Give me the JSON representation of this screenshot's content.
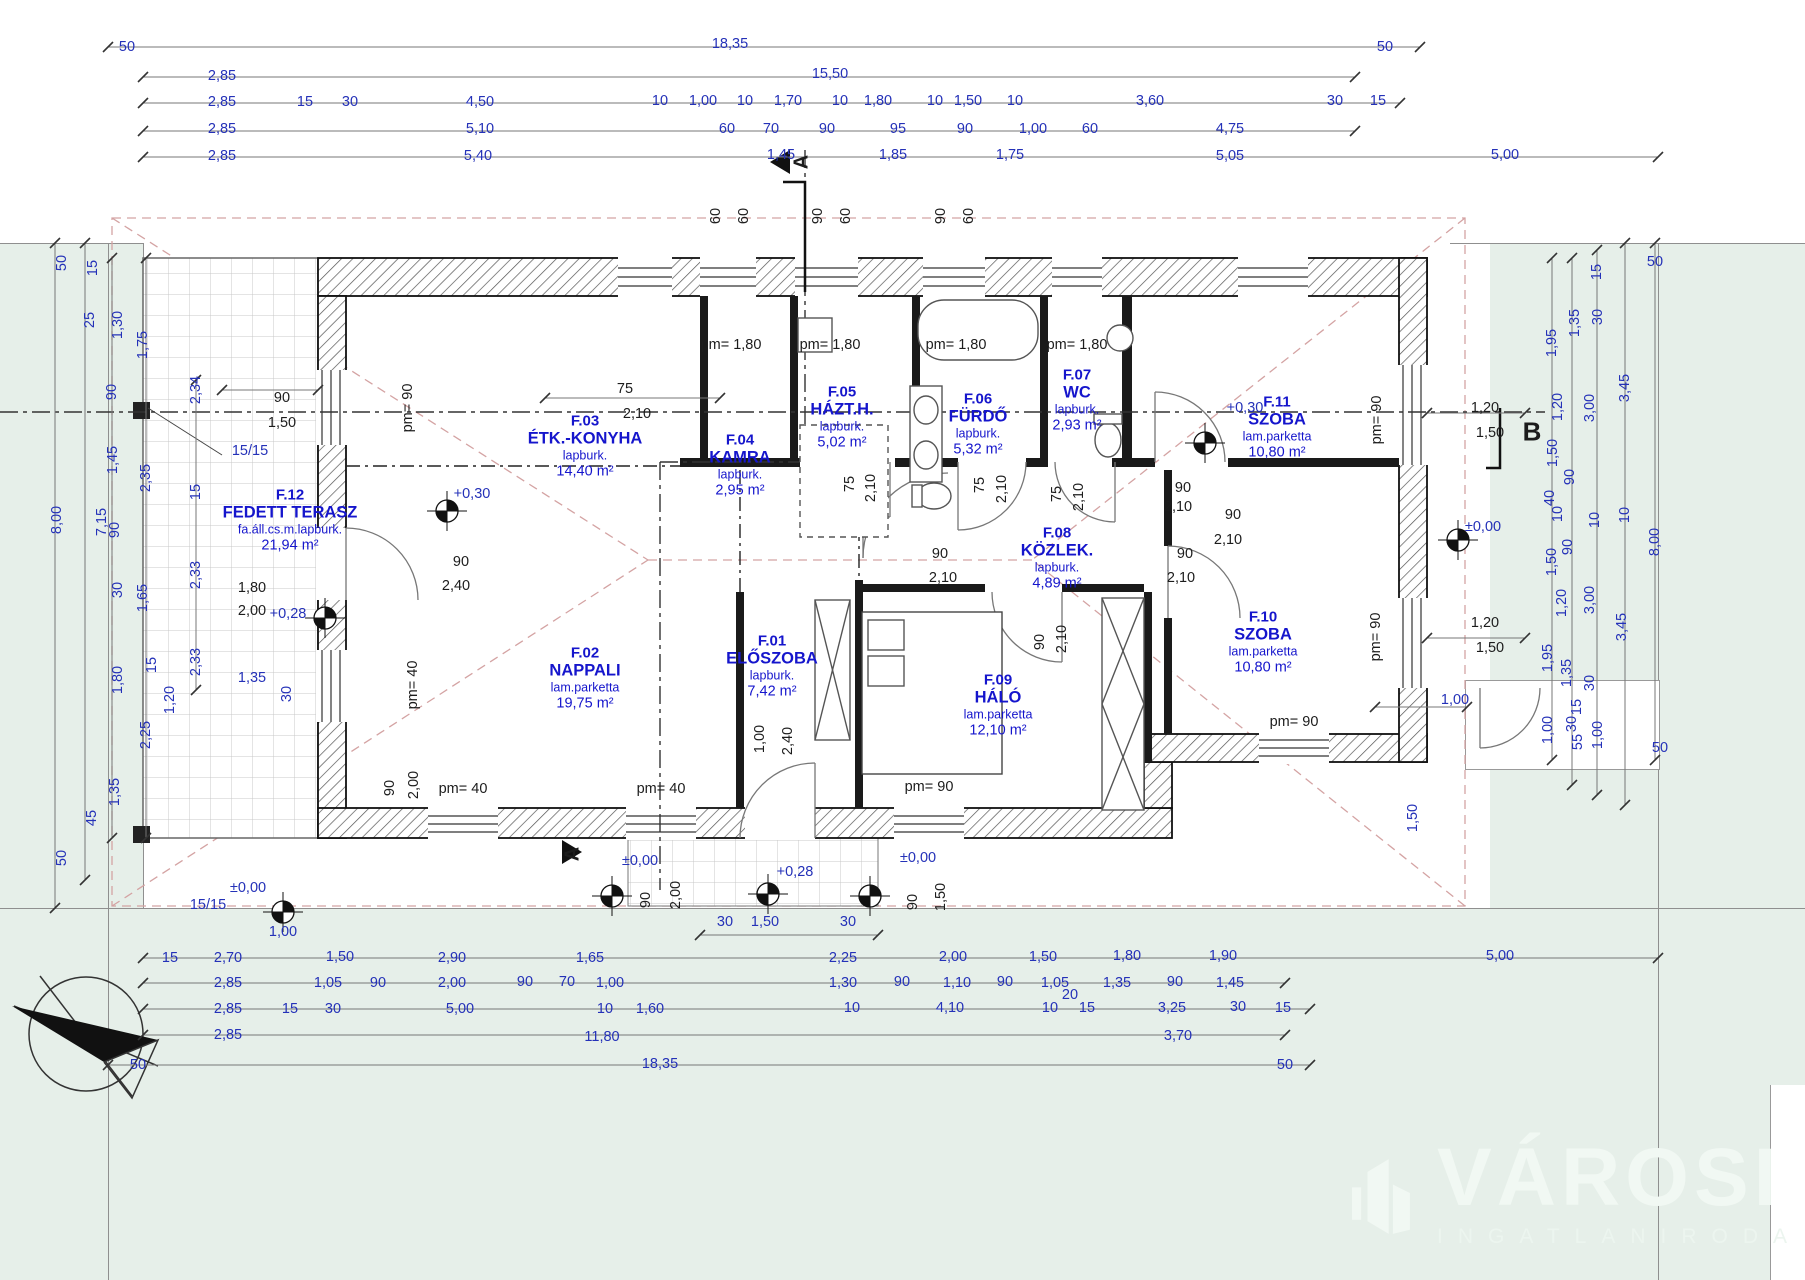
{
  "logo": {
    "title": "VÁROSI",
    "subtitle": "INGATLANIRODA",
    "color": "#f1f8f3"
  },
  "colors": {
    "terrain": "#e6efe9",
    "dim_blue": "#2431b8",
    "room_blue": "#1515cc",
    "roof_dash": "#d4a3a3"
  },
  "rooms": [
    {
      "id": "F.01",
      "name": "ELŐSZOBA",
      "finish": "lapburk.",
      "area": "7,42 m²",
      "cx": 772,
      "cy": 666
    },
    {
      "id": "F.02",
      "name": "NAPPALI",
      "finish": "lam.parketta",
      "area": "19,75 m²",
      "cx": 585,
      "cy": 678
    },
    {
      "id": "F.03",
      "name": "ÉTK.-KONYHA",
      "finish": "lapburk.",
      "area": "14,40 m²",
      "cx": 585,
      "cy": 446
    },
    {
      "id": "F.04",
      "name": "KAMRA",
      "finish": "lapburk.",
      "area": "2,95 m²",
      "cx": 740,
      "cy": 465
    },
    {
      "id": "F.05",
      "name": "HÁZT.H.",
      "finish": "lapburk.",
      "area": "5,02 m²",
      "cx": 842,
      "cy": 417
    },
    {
      "id": "F.06",
      "name": "FÜRDŐ",
      "finish": "lapburk.",
      "area": "5,32 m²",
      "cx": 978,
      "cy": 424
    },
    {
      "id": "F.07",
      "name": "WC",
      "finish": "lapburk.",
      "area": "2,93 m²",
      "cx": 1077,
      "cy": 400
    },
    {
      "id": "F.08",
      "name": "KÖZLEK.",
      "finish": "lapburk.",
      "area": "4,89 m²",
      "cx": 1057,
      "cy": 558
    },
    {
      "id": "F.09",
      "name": "HÁLÓ",
      "finish": "lam.parketta",
      "area": "12,10 m²",
      "cx": 998,
      "cy": 705
    },
    {
      "id": "F.10",
      "name": "SZOBA",
      "finish": "lam.parketta",
      "area": "10,80 m²",
      "cx": 1263,
      "cy": 642
    },
    {
      "id": "F.11",
      "name": "SZOBA",
      "finish": "lam.parketta",
      "area": "10,80 m²",
      "cx": 1277,
      "cy": 427
    },
    {
      "id": "F.12",
      "name": "FEDETT TERASZ",
      "finish": "fa.áll.cs.m.lapburk.",
      "area": "21,94 m²",
      "cx": 290,
      "cy": 520
    }
  ],
  "dims": [
    [
      "50",
      127,
      47
    ],
    [
      "18,35",
      730,
      44
    ],
    [
      "50",
      1385,
      47
    ],
    [
      "2,85",
      222,
      76
    ],
    [
      "15,50",
      830,
      74
    ],
    [
      "2,85",
      222,
      102
    ],
    [
      "15",
      305,
      102
    ],
    [
      "30",
      350,
      102
    ],
    [
      "4,50",
      480,
      102
    ],
    [
      "10",
      660,
      101
    ],
    [
      "1,00",
      703,
      101
    ],
    [
      "10",
      745,
      101
    ],
    [
      "1,70",
      788,
      101
    ],
    [
      "10",
      840,
      101
    ],
    [
      "1,80",
      878,
      101
    ],
    [
      "10",
      935,
      101
    ],
    [
      "1,50",
      968,
      101
    ],
    [
      "10",
      1015,
      101
    ],
    [
      "3,60",
      1150,
      101
    ],
    [
      "30",
      1335,
      101
    ],
    [
      "15",
      1378,
      101
    ],
    [
      "2,85",
      222,
      129
    ],
    [
      "5,10",
      480,
      129
    ],
    [
      "60",
      727,
      129
    ],
    [
      "70",
      771,
      129
    ],
    [
      "90",
      827,
      129
    ],
    [
      "95",
      898,
      129
    ],
    [
      "90",
      965,
      129
    ],
    [
      "1,00",
      1033,
      129
    ],
    [
      "60",
      1090,
      129
    ],
    [
      "4,75",
      1230,
      129
    ],
    [
      "2,85",
      222,
      156
    ],
    [
      "5,40",
      478,
      156
    ],
    [
      "1,45",
      781,
      155
    ],
    [
      "1,85",
      893,
      155
    ],
    [
      "1,75",
      1010,
      155
    ],
    [
      "5,05",
      1230,
      156
    ],
    [
      "5,00",
      1505,
      155
    ],
    [
      "60",
      716,
      216,
      1,
      1
    ],
    [
      "60",
      744,
      216,
      1,
      1
    ],
    [
      "90",
      818,
      216,
      1,
      1
    ],
    [
      "60",
      846,
      216,
      1,
      1
    ],
    [
      "90",
      941,
      216,
      1,
      1
    ],
    [
      "60",
      969,
      216,
      1,
      1
    ],
    [
      "15",
      170,
      958
    ],
    [
      "2,70",
      228,
      958
    ],
    [
      "1,50",
      340,
      957
    ],
    [
      "2,90",
      452,
      958
    ],
    [
      "1,65",
      590,
      958
    ],
    [
      "2,25",
      843,
      958
    ],
    [
      "2,00",
      953,
      957
    ],
    [
      "1,50",
      1043,
      957
    ],
    [
      "1,80",
      1127,
      956
    ],
    [
      "1,90",
      1223,
      956
    ],
    [
      "5,00",
      1500,
      956
    ],
    [
      "2,85",
      228,
      983
    ],
    [
      "1,05",
      328,
      983
    ],
    [
      "90",
      378,
      983
    ],
    [
      "2,00",
      452,
      983
    ],
    [
      "90",
      525,
      982
    ],
    [
      "70",
      567,
      982
    ],
    [
      "1,00",
      610,
      983
    ],
    [
      "1,30",
      843,
      983
    ],
    [
      "90",
      902,
      982
    ],
    [
      "1,10",
      957,
      983
    ],
    [
      "90",
      1005,
      982
    ],
    [
      "1,05",
      1055,
      983
    ],
    [
      "20",
      1070,
      995
    ],
    [
      "1,35",
      1117,
      983
    ],
    [
      "90",
      1175,
      982
    ],
    [
      "1,45",
      1230,
      983
    ],
    [
      "2,85",
      228,
      1009
    ],
    [
      "15",
      290,
      1009
    ],
    [
      "30",
      333,
      1009
    ],
    [
      "5,00",
      460,
      1009
    ],
    [
      "10",
      605,
      1009
    ],
    [
      "1,60",
      650,
      1009
    ],
    [
      "10",
      852,
      1008
    ],
    [
      "4,10",
      950,
      1008
    ],
    [
      "10",
      1050,
      1008
    ],
    [
      "15",
      1087,
      1008
    ],
    [
      "3,25",
      1172,
      1008
    ],
    [
      "30",
      1238,
      1007
    ],
    [
      "15",
      1283,
      1008
    ],
    [
      "2,85",
      228,
      1035
    ],
    [
      "11,80",
      602,
      1037
    ],
    [
      "3,70",
      1178,
      1036
    ],
    [
      "50",
      138,
      1065
    ],
    [
      "18,35",
      660,
      1064
    ],
    [
      "50",
      1285,
      1065
    ],
    [
      "30",
      725,
      922
    ],
    [
      "1,50",
      765,
      922
    ],
    [
      "30",
      848,
      922
    ],
    [
      "90",
      646,
      900,
      1,
      1
    ],
    [
      "2,00",
      676,
      895,
      1,
      1
    ],
    [
      "90",
      913,
      902,
      1,
      1
    ],
    [
      "1,50",
      941,
      897,
      1,
      1
    ],
    [
      "90",
      390,
      788,
      1,
      1
    ],
    [
      "2,00",
      414,
      785,
      1,
      1
    ],
    [
      "50",
      62,
      263,
      1
    ],
    [
      "15",
      93,
      268,
      1
    ],
    [
      "25",
      90,
      320,
      1
    ],
    [
      "1,30",
      118,
      325,
      1
    ],
    [
      "1,75",
      143,
      345,
      1
    ],
    [
      "2,34",
      196,
      390,
      1
    ],
    [
      "90",
      112,
      392,
      1
    ],
    [
      "1,45",
      113,
      460,
      1
    ],
    [
      "2,35",
      146,
      478,
      1
    ],
    [
      "8,00",
      57,
      520,
      1
    ],
    [
      "7,15",
      102,
      522,
      1
    ],
    [
      "90",
      115,
      530,
      1
    ],
    [
      "15",
      196,
      492,
      1
    ],
    [
      "2,33",
      196,
      575,
      1
    ],
    [
      "30",
      118,
      590,
      1
    ],
    [
      "1,65",
      143,
      598,
      1
    ],
    [
      "1,80",
      118,
      680,
      1
    ],
    [
      "2,33",
      196,
      662,
      1
    ],
    [
      "2,25",
      146,
      735,
      1
    ],
    [
      "1,35",
      115,
      792,
      1
    ],
    [
      "45",
      92,
      818,
      1
    ],
    [
      "50",
      62,
      858,
      1
    ],
    [
      "15",
      152,
      665,
      1
    ],
    [
      "1,20",
      170,
      700,
      1
    ],
    [
      "1,35",
      252,
      678
    ],
    [
      "30",
      287,
      694,
      1
    ],
    [
      "±0,00",
      248,
      888
    ],
    [
      "1,00",
      283,
      932
    ],
    [
      "15/15",
      250,
      451
    ],
    [
      "15/15",
      208,
      905
    ],
    [
      "15",
      1597,
      272,
      1
    ],
    [
      "50",
      1655,
      262
    ],
    [
      "1,35",
      1575,
      323,
      1
    ],
    [
      "30",
      1598,
      317,
      1
    ],
    [
      "1,95",
      1552,
      343,
      1
    ],
    [
      "3,45",
      1625,
      388,
      1
    ],
    [
      "1,20",
      1558,
      407,
      1
    ],
    [
      "3,00",
      1590,
      408,
      1
    ],
    [
      "1,50",
      1553,
      453,
      1
    ],
    [
      "90",
      1570,
      477,
      1
    ],
    [
      "40",
      1550,
      498,
      1
    ],
    [
      "10",
      1558,
      514,
      1
    ],
    [
      "10",
      1595,
      520,
      1
    ],
    [
      "10",
      1625,
      515,
      1
    ],
    [
      "8,00",
      1655,
      542,
      1
    ],
    [
      "90",
      1568,
      547,
      1
    ],
    [
      "1,50",
      1552,
      562,
      1
    ],
    [
      "1,20",
      1562,
      603,
      1
    ],
    [
      "3,00",
      1590,
      600,
      1
    ],
    [
      "3,45",
      1622,
      627,
      1
    ],
    [
      "1,95",
      1548,
      658,
      1
    ],
    [
      "1,35",
      1567,
      673,
      1
    ],
    [
      "30",
      1590,
      683,
      1
    ],
    [
      "15",
      1577,
      707,
      1
    ],
    [
      "1,00",
      1548,
      730,
      1
    ],
    [
      "30",
      1572,
      724,
      1
    ],
    [
      "55",
      1578,
      742,
      1
    ],
    [
      "1,00",
      1598,
      735,
      1
    ],
    [
      "50",
      1660,
      748
    ],
    [
      "1,00",
      1455,
      700
    ],
    [
      "1,50",
      1413,
      818,
      1
    ],
    [
      "±0,00",
      1483,
      527
    ],
    [
      "pm= 1,80",
      731,
      345,
      0,
      1
    ],
    [
      "pm= 1,80",
      830,
      345,
      0,
      1
    ],
    [
      "pm= 1,80",
      956,
      345,
      0,
      1
    ],
    [
      "pm= 1,80",
      1077,
      345,
      0,
      1
    ],
    [
      "pm= 90",
      408,
      408,
      1,
      1
    ],
    [
      "pm= 40",
      413,
      685,
      1,
      1
    ],
    [
      "pm= 40",
      463,
      789,
      0,
      1
    ],
    [
      "pm= 40",
      661,
      789,
      0,
      1
    ],
    [
      "pm= 90",
      929,
      787,
      0,
      1
    ],
    [
      "pm= 90",
      1294,
      722,
      0,
      1
    ],
    [
      "pm= 90",
      1377,
      420,
      1,
      1
    ],
    [
      "pm= 90",
      1376,
      637,
      1,
      1
    ],
    [
      "75",
      625,
      389,
      0,
      1
    ],
    [
      "2,10",
      637,
      414,
      0,
      1
    ],
    [
      "75",
      850,
      484,
      1,
      1
    ],
    [
      "2,10",
      871,
      488,
      1,
      1
    ],
    [
      "75",
      980,
      485,
      1,
      1
    ],
    [
      "2,10",
      1002,
      489,
      1,
      1
    ],
    [
      "75",
      1057,
      494,
      1,
      1
    ],
    [
      "2,10",
      1079,
      497,
      1,
      1
    ],
    [
      "90",
      940,
      554,
      0,
      1
    ],
    [
      "2,10",
      943,
      578,
      0,
      1
    ],
    [
      "90",
      1183,
      488,
      0,
      1
    ],
    [
      "2,10",
      1178,
      507,
      0,
      1
    ],
    [
      "90",
      1185,
      554,
      0,
      1
    ],
    [
      "2,10",
      1181,
      578,
      0,
      1
    ],
    [
      "90",
      1233,
      515,
      0,
      1
    ],
    [
      "2,10",
      1228,
      540,
      0,
      1
    ],
    [
      "90",
      1040,
      642,
      1,
      1
    ],
    [
      "2,10",
      1062,
      639,
      1,
      1
    ],
    [
      "90",
      461,
      562,
      0,
      1
    ],
    [
      "2,40",
      456,
      586,
      0,
      1
    ],
    [
      "1,00",
      760,
      739,
      1,
      1
    ],
    [
      "2,40",
      788,
      741,
      1,
      1
    ],
    [
      "90",
      282,
      398,
      0,
      1
    ],
    [
      "1,50",
      282,
      423,
      0,
      1
    ],
    [
      "1,80",
      252,
      588,
      0,
      1
    ],
    [
      "2,00",
      252,
      611,
      0,
      1
    ],
    [
      "1,20",
      1485,
      408,
      0,
      1
    ],
    [
      "1,50",
      1490,
      433,
      0,
      1
    ],
    [
      "1,20",
      1485,
      623,
      0,
      1
    ],
    [
      "1,50",
      1490,
      648,
      0,
      1
    ],
    [
      "+0,30",
      472,
      494
    ],
    [
      "+0,30",
      1245,
      408
    ],
    [
      "+0,28",
      288,
      614
    ],
    [
      "+0,28",
      795,
      872
    ],
    [
      "±0,00",
      640,
      861
    ],
    [
      "±0,00",
      918,
      858
    ],
    [
      "A",
      802,
      162,
      1,
      1,
      20
    ],
    [
      "A",
      573,
      854,
      1,
      1,
      20
    ],
    [
      "B",
      1532,
      432,
      0,
      1,
      26
    ]
  ]
}
